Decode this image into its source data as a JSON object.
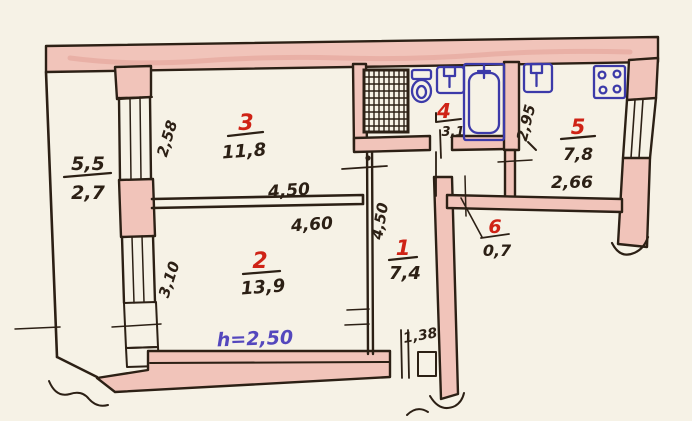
{
  "document": {
    "kind": "hand-drawn apartment floor plan sketch"
  },
  "colors": {
    "paper": "#f6f2e6",
    "ink": "#2c2015",
    "wall_fill": "#f1c4ba",
    "room_number_red": "#cf2316",
    "fixture_blue": "#3c3aa9",
    "height_note_purple": "#5447bd"
  },
  "rooms": [
    {
      "number": "1",
      "area": "7,4"
    },
    {
      "number": "2",
      "area": "13,9"
    },
    {
      "number": "3",
      "area": "11,8"
    },
    {
      "number": "4",
      "area": "3,1"
    },
    {
      "number": "5",
      "area": "7,8"
    },
    {
      "number": "6",
      "area": "0,7"
    }
  ],
  "balcony": {
    "top": "5,5",
    "bottom": "2,7"
  },
  "dims": {
    "room3_width": "4,50",
    "room2_width": "4,60",
    "room3_depth": "2,58",
    "room2_depth": "3,10",
    "hall_length": "4,50",
    "kitchen_depth": "2,95",
    "kitchen_width": "2,66",
    "entry_width": "1,38"
  },
  "height_note": "h=2,50",
  "fixtures": {
    "shaft": "ventilation-shaft",
    "toilet": "toilet",
    "bath_sink": "washbasin",
    "bathtub": "bathtub",
    "kitchen_sink": "kitchen-sink",
    "stove": "stove"
  }
}
